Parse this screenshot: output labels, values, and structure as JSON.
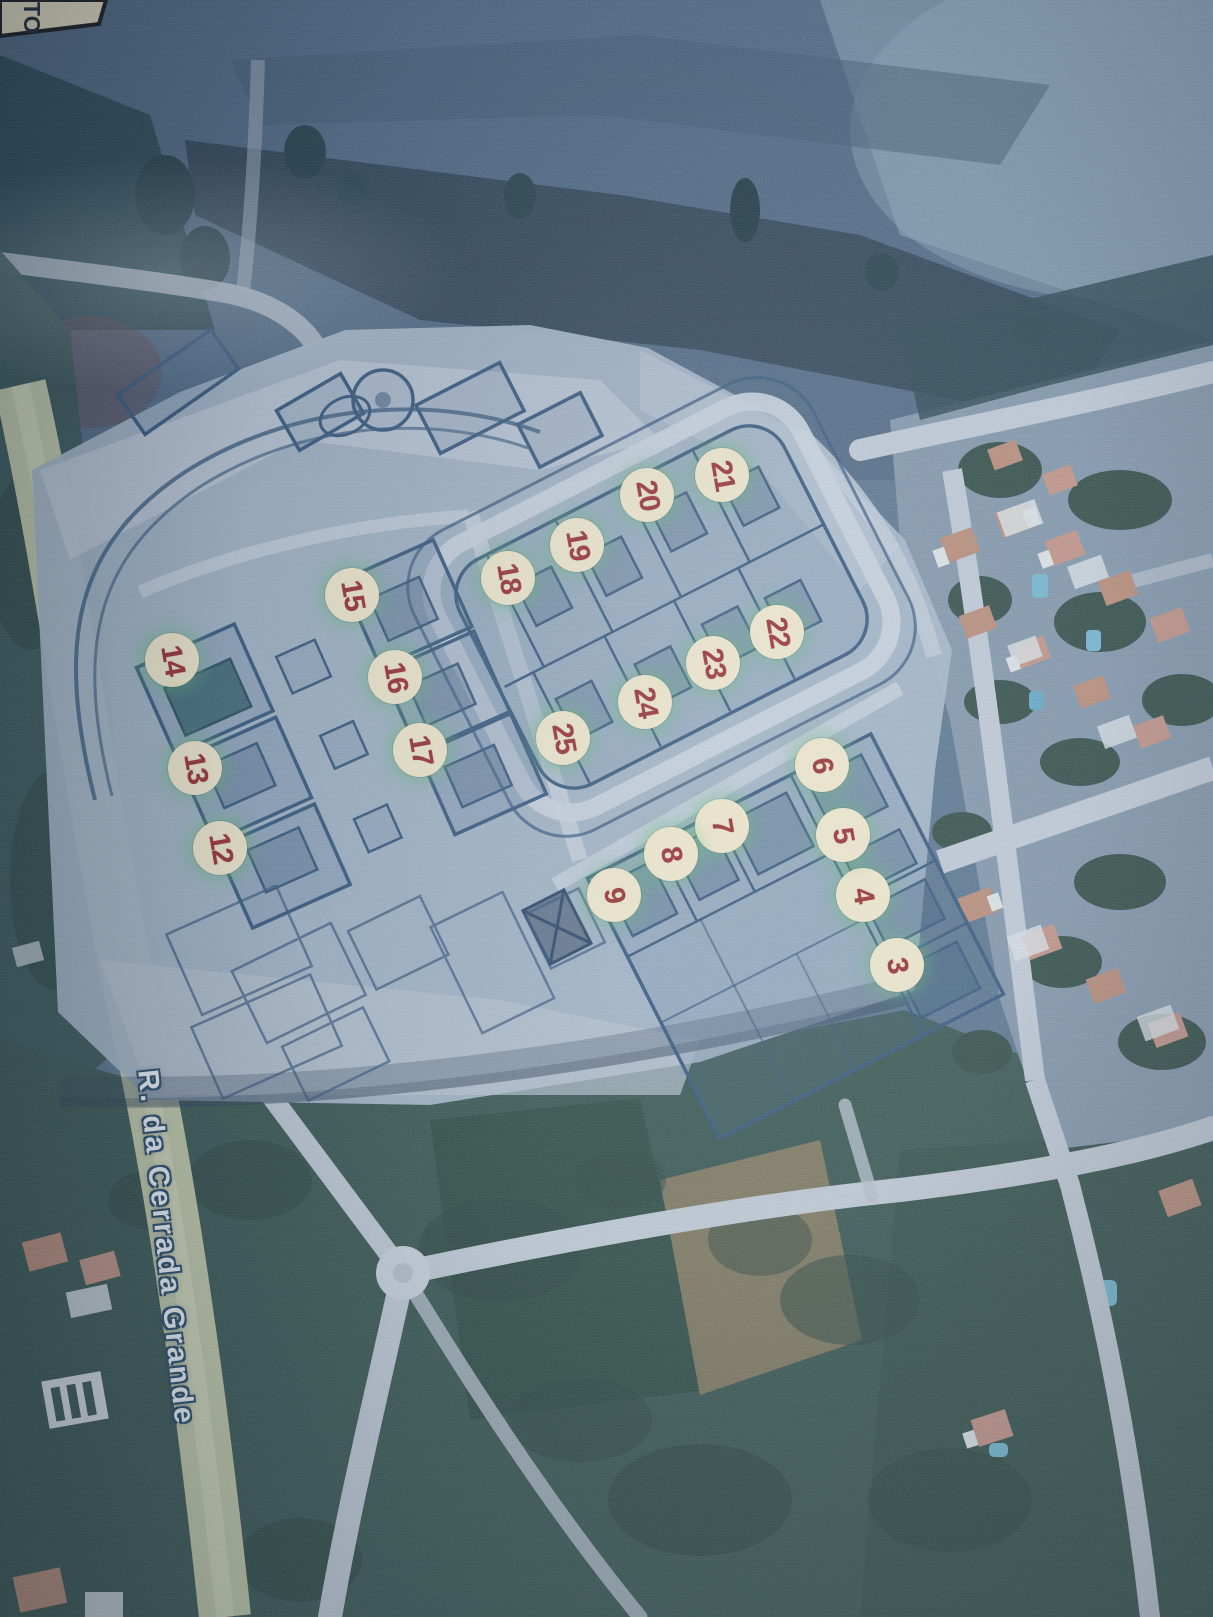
{
  "scene": {
    "description": "Photograph of a printed aerial/satellite plan of a housing subdivision with numbered lot markers",
    "corner_label": "TO",
    "street_label": "R. da Cerrada Grande",
    "lot_markers": [
      {
        "label": "3",
        "x": 897,
        "y": 965
      },
      {
        "label": "4",
        "x": 863,
        "y": 895
      },
      {
        "label": "5",
        "x": 843,
        "y": 835
      },
      {
        "label": "6",
        "x": 822,
        "y": 765
      },
      {
        "label": "7",
        "x": 722,
        "y": 826
      },
      {
        "label": "8",
        "x": 671,
        "y": 854
      },
      {
        "label": "9",
        "x": 614,
        "y": 895
      },
      {
        "label": "12",
        "x": 220,
        "y": 848
      },
      {
        "label": "13",
        "x": 195,
        "y": 768
      },
      {
        "label": "14",
        "x": 172,
        "y": 660
      },
      {
        "label": "15",
        "x": 352,
        "y": 595
      },
      {
        "label": "16",
        "x": 395,
        "y": 677
      },
      {
        "label": "17",
        "x": 420,
        "y": 750
      },
      {
        "label": "18",
        "x": 508,
        "y": 578
      },
      {
        "label": "19",
        "x": 577,
        "y": 545
      },
      {
        "label": "20",
        "x": 647,
        "y": 495
      },
      {
        "label": "21",
        "x": 722,
        "y": 475
      },
      {
        "label": "22",
        "x": 777,
        "y": 632
      },
      {
        "label": "23",
        "x": 713,
        "y": 663
      },
      {
        "label": "24",
        "x": 645,
        "y": 702
      },
      {
        "label": "25",
        "x": 563,
        "y": 738
      }
    ],
    "colors": {
      "marker_fill": "#f1e8cc",
      "marker_text": "#9c3434",
      "street_label_text": "#eef2f5",
      "street_label_outline": "#2d4f6b",
      "corner_box_fill": "#ece2c2",
      "corner_box_text": "#15202c",
      "lot_line": "#2f527a",
      "plat_fill": "#a7b8ca"
    }
  }
}
